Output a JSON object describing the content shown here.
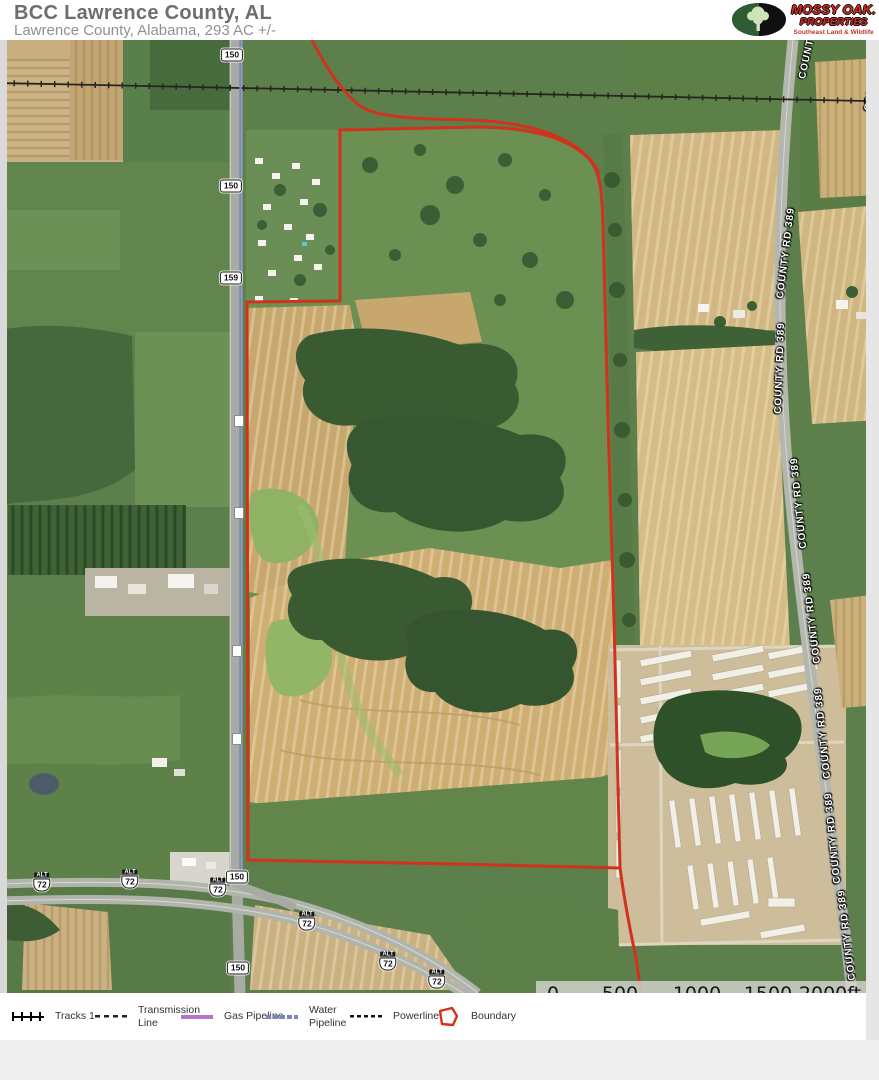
{
  "header": {
    "title": "BCC Lawrence County, AL",
    "subtitle": "Lawrence County, Alabama, 293 AC +/-"
  },
  "logo": {
    "line1": "MOSSY OAK.",
    "line2": "PROPERTIES",
    "line3": "Southeast Land & Wildlife"
  },
  "colors": {
    "boundary_red": "#d2311e",
    "gas_pipeline": "#b573c9",
    "water_pipeline": "#7b85c4"
  },
  "map": {
    "route_shields": [
      {
        "label": "150",
        "x": 232,
        "y": 55
      },
      {
        "label": "150",
        "x": 231,
        "y": 186
      },
      {
        "label": "159",
        "x": 231,
        "y": 278
      },
      {
        "label": "150",
        "x": 237,
        "y": 877
      },
      {
        "label": "150",
        "x": 238,
        "y": 968
      }
    ],
    "small_markers": [
      {
        "x": 239,
        "y": 421
      },
      {
        "x": 239,
        "y": 513
      },
      {
        "x": 237,
        "y": 651
      },
      {
        "x": 237,
        "y": 739
      }
    ],
    "alt_shield": {
      "banner": "ALT",
      "number": "72"
    },
    "alt_positions": [
      {
        "x": 42,
        "y": 882
      },
      {
        "x": 130,
        "y": 879
      },
      {
        "x": 218,
        "y": 887
      },
      {
        "x": 307,
        "y": 921
      },
      {
        "x": 388,
        "y": 961
      },
      {
        "x": 437,
        "y": 979
      }
    ],
    "road_label": "COUNTY RD 389",
    "road_label_positions": [
      {
        "x": 812,
        "y": 34,
        "rot": -78
      },
      {
        "x": 876,
        "y": 66,
        "rot": -80
      },
      {
        "x": 786,
        "y": 253,
        "rot": -83
      },
      {
        "x": 780,
        "y": 368,
        "rot": -88
      },
      {
        "x": 799,
        "y": 503,
        "rot": -96
      },
      {
        "x": 812,
        "y": 618,
        "rot": -97
      },
      {
        "x": 823,
        "y": 733,
        "rot": -96
      },
      {
        "x": 833,
        "y": 838,
        "rot": -96
      },
      {
        "x": 847,
        "y": 935,
        "rot": -97
      }
    ],
    "scalebar": {
      "labels": [
        "0",
        "500",
        "1000",
        "1500",
        "2000ft"
      ]
    }
  },
  "legend": {
    "items": [
      {
        "label": "Tracks 1",
        "type": "tracks"
      },
      {
        "label": "Transmission Line",
        "type": "dash"
      },
      {
        "label": "Gas Pipeline",
        "type": "gas"
      },
      {
        "label": "Water Pipeline",
        "type": "water"
      },
      {
        "label": "Powerline",
        "type": "power"
      },
      {
        "label": "Boundary",
        "type": "bound"
      }
    ]
  }
}
